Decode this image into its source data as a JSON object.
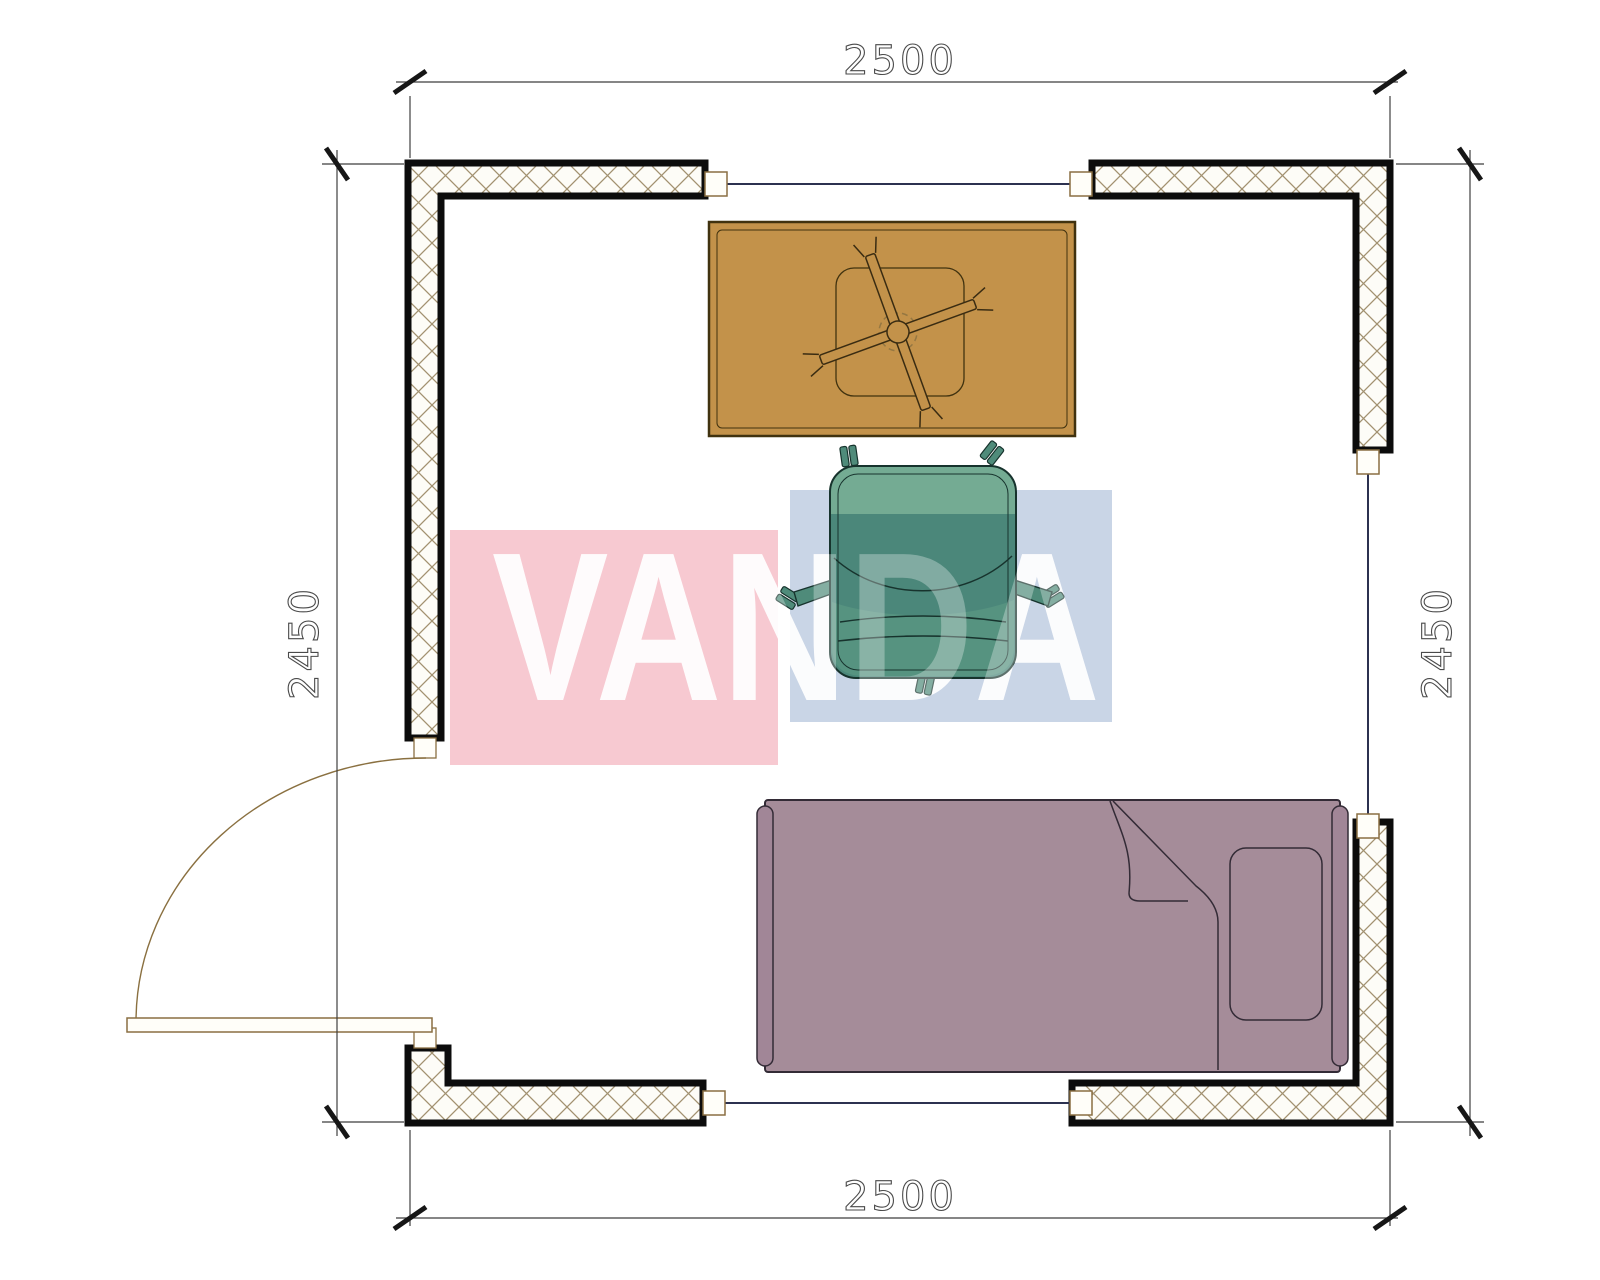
{
  "title": "Room floor plan drawing",
  "dimensions": {
    "top": "2500",
    "bottom": "2500",
    "left": "2450",
    "right": "2450",
    "units": "mm"
  },
  "watermark": {
    "text": "VANDA",
    "pink_block_color": "#f7c9d1",
    "blue_block_color": "#c9d5e6",
    "text_color": "#ffffff"
  },
  "furniture": {
    "desk": {
      "label": "desk with ceiling fan",
      "color": "#c3924a"
    },
    "chair": {
      "label": "office swivel chair",
      "color": "#4b877a"
    },
    "bed": {
      "label": "single bed with pillow and folded blanket",
      "color": "#a58c99"
    }
  },
  "colors": {
    "wall_outline": "#0c0c0c",
    "wall_hatch": "#a29170",
    "window_line": "#2c3150",
    "door": "#8a7040",
    "dimension": "#3f3f3f"
  }
}
